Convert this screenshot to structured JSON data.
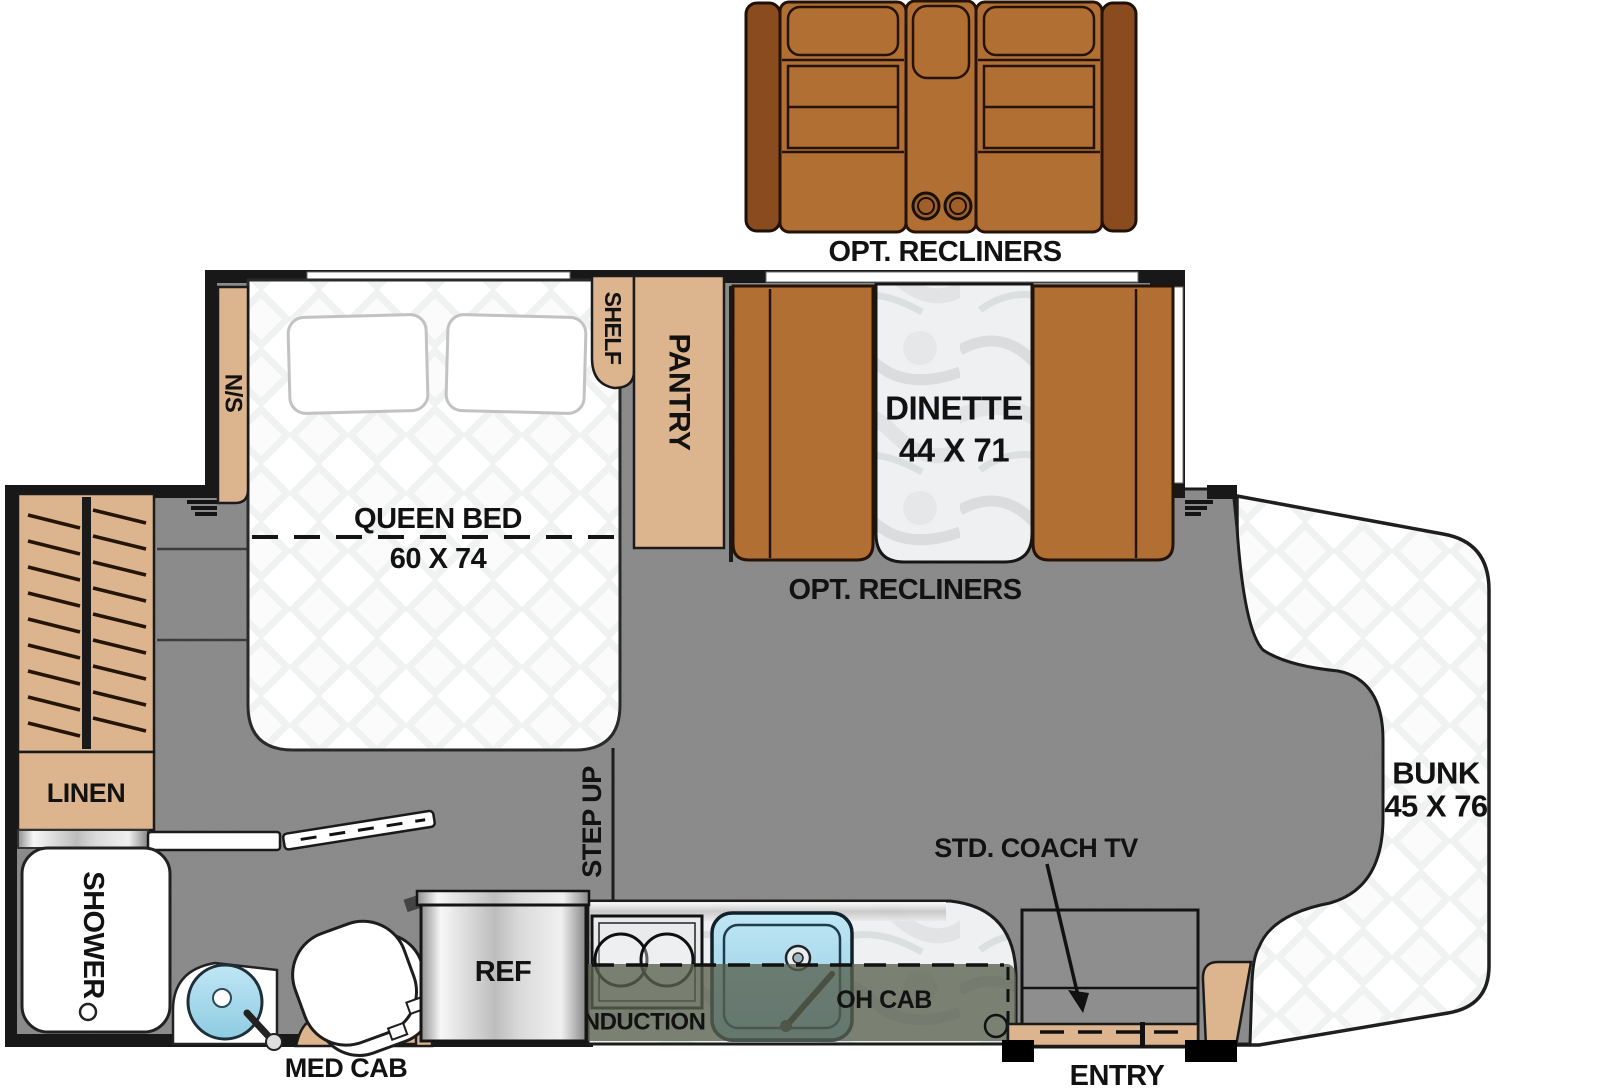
{
  "title": "RV Motorhome Floor Plan",
  "labels": {
    "opt_recliners_top": "OPT. RECLINERS",
    "opt_recliners_bottom": "OPT. RECLINERS",
    "dinette_name": "DINETTE",
    "dinette_size": "44 X 71",
    "queen_bed_name": "QUEEN BED",
    "queen_bed_size": "60 X 74",
    "nightstand": "N/S",
    "shelf": "SHELF",
    "pantry": "PANTRY",
    "linen": "LINEN",
    "shower": "SHOWER",
    "step_up": "STEP UP",
    "bunk_name": "BUNK",
    "bunk_size": "45 X 76",
    "coach_tv": "STD. COACH TV",
    "refrigerator": "REF",
    "induction": "INDUCTION",
    "overhead_cabinet": "OH CAB",
    "medicine_cabinet": "MED CAB",
    "entry": "ENTRY"
  },
  "colors": {
    "outline": "#181818",
    "wood_tan": "#dcb58f",
    "seat_brown": "#b26f33",
    "arm_brown": "#8a4c1e",
    "floor_gray": "#8e8e8e",
    "overhead_cab_olive": "#59604e",
    "sink_blue": "#a9d9ec",
    "quilt_white": "#ffffff",
    "marble": "#eff0f1"
  }
}
